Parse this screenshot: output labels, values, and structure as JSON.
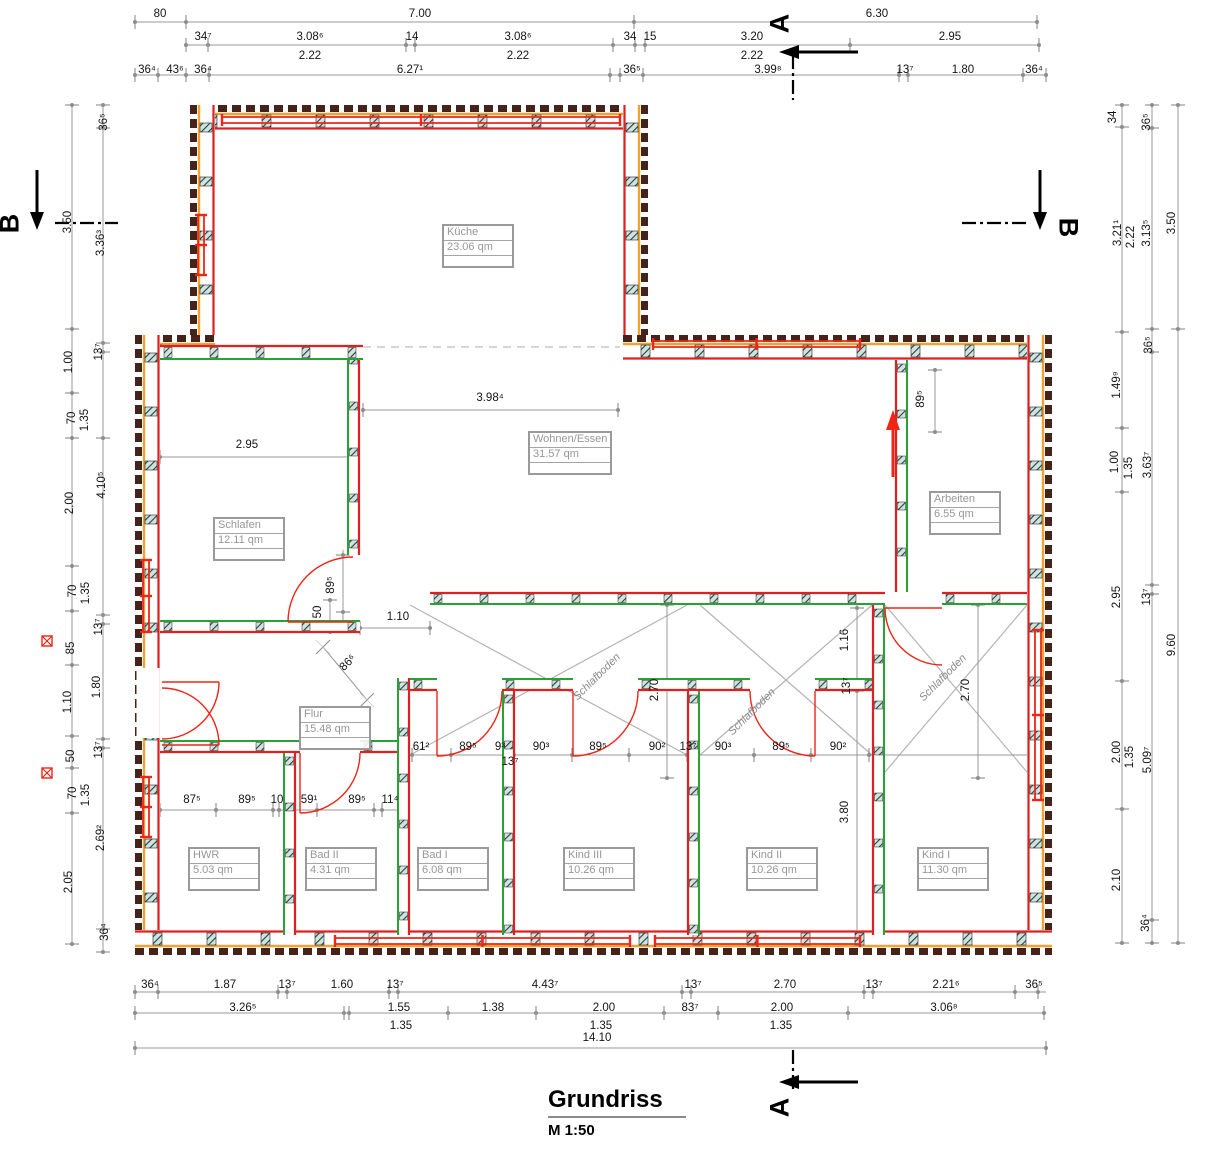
{
  "title": {
    "name": "Grundriss",
    "scale": "M 1:50"
  },
  "colors": {
    "wall_dark": "#45231a",
    "insulation_orange": "#f0a232",
    "inner_red": "#e02020",
    "partition_green": "#2aa233",
    "dim_gray": "#9a9a9a",
    "label_gray": "#979797",
    "window_red": "#ee2517",
    "zone_gray": "#b4b4b4"
  },
  "section_markers": {
    "top": "A",
    "bottom": "A",
    "left": "B",
    "right": "B"
  },
  "rooms": [
    {
      "name": "Küche",
      "area": "23.06 qm",
      "x": 442,
      "y": 224
    },
    {
      "name": "Wohnen/Essen",
      "area": "31.57 qm",
      "x": 528,
      "y": 431
    },
    {
      "name": "Schlafen",
      "area": "12.11 qm",
      "x": 213,
      "y": 517
    },
    {
      "name": "Arbeiten",
      "area": "6.55 qm",
      "x": 929,
      "y": 491
    },
    {
      "name": "Flur",
      "area": "15.48 qm",
      "x": 299,
      "y": 706
    },
    {
      "name": "HWR",
      "area": "5.03 qm",
      "x": 188,
      "y": 847
    },
    {
      "name": "Bad II",
      "area": "4.31 qm",
      "x": 305,
      "y": 847
    },
    {
      "name": "Bad I",
      "area": "6.08 qm",
      "x": 417,
      "y": 847
    },
    {
      "name": "Kind III",
      "area": "10.26 qm",
      "x": 563,
      "y": 847
    },
    {
      "name": "Kind II",
      "area": "10.26 qm",
      "x": 746,
      "y": 847
    },
    {
      "name": "Kind I",
      "area": "11.30 qm",
      "x": 917,
      "y": 847
    }
  ],
  "schlafboden_labels": [
    {
      "text": "Schlafboden",
      "x": 597,
      "y": 677
    },
    {
      "text": "Schlafboden",
      "x": 752,
      "y": 712
    },
    {
      "text": "Schlafboden",
      "x": 943,
      "y": 678
    }
  ],
  "dim_labels": [
    {
      "t": "80",
      "x": 160,
      "y": 14
    },
    {
      "t": "7.00",
      "x": 420,
      "y": 14
    },
    {
      "t": "6.30",
      "x": 877,
      "y": 14
    },
    {
      "t": "34⁷",
      "x": 203,
      "y": 37
    },
    {
      "t": "3.08⁶",
      "x": 310,
      "y": 37
    },
    {
      "t": "14",
      "x": 412,
      "y": 37
    },
    {
      "t": "3.08⁶",
      "x": 518,
      "y": 37
    },
    {
      "t": "34",
      "x": 630,
      "y": 37
    },
    {
      "t": "15",
      "x": 650,
      "y": 37
    },
    {
      "t": "3.20",
      "x": 752,
      "y": 37
    },
    {
      "t": "2.95",
      "x": 950,
      "y": 37
    },
    {
      "t": "2.22",
      "x": 310,
      "y": 56
    },
    {
      "t": "2.22",
      "x": 518,
      "y": 56
    },
    {
      "t": "2.22",
      "x": 752,
      "y": 56
    },
    {
      "t": "36⁴",
      "x": 147,
      "y": 70
    },
    {
      "t": "43⁶",
      "x": 175,
      "y": 70
    },
    {
      "t": "36⁴",
      "x": 203,
      "y": 70
    },
    {
      "t": "6.27¹",
      "x": 410,
      "y": 70
    },
    {
      "t": "36⁵",
      "x": 632,
      "y": 70
    },
    {
      "t": "3.99⁸",
      "x": 768,
      "y": 70
    },
    {
      "t": "13⁷",
      "x": 905,
      "y": 70
    },
    {
      "t": "1.80",
      "x": 963,
      "y": 70
    },
    {
      "t": "36⁴",
      "x": 1034,
      "y": 70
    },
    {
      "t": "36⁴",
      "x": 150,
      "y": 985
    },
    {
      "t": "1.87",
      "x": 225,
      "y": 985
    },
    {
      "t": "13⁷",
      "x": 287,
      "y": 985
    },
    {
      "t": "1.60",
      "x": 342,
      "y": 985
    },
    {
      "t": "13⁷",
      "x": 395,
      "y": 985
    },
    {
      "t": "4.43⁷",
      "x": 545,
      "y": 985
    },
    {
      "t": "13⁷",
      "x": 693,
      "y": 985
    },
    {
      "t": "2.70",
      "x": 785,
      "y": 985
    },
    {
      "t": "13⁷",
      "x": 874,
      "y": 985
    },
    {
      "t": "2.21⁶",
      "x": 946,
      "y": 985
    },
    {
      "t": "36⁵",
      "x": 1034,
      "y": 985
    },
    {
      "t": "3.26⁵",
      "x": 243,
      "y": 1008
    },
    {
      "t": "1.55",
      "x": 399,
      "y": 1008
    },
    {
      "t": "1.38",
      "x": 493,
      "y": 1008
    },
    {
      "t": "2.00",
      "x": 604,
      "y": 1008
    },
    {
      "t": "83⁷",
      "x": 690,
      "y": 1008
    },
    {
      "t": "2.00",
      "x": 782,
      "y": 1008
    },
    {
      "t": "3.06⁸",
      "x": 944,
      "y": 1008
    },
    {
      "t": "1.35",
      "x": 401,
      "y": 1026
    },
    {
      "t": "1.35",
      "x": 601,
      "y": 1026
    },
    {
      "t": "1.35",
      "x": 781,
      "y": 1026
    },
    {
      "t": "14.10",
      "x": 597,
      "y": 1038
    },
    {
      "t": "3.50",
      "x": 68,
      "y": 222,
      "r": -90
    },
    {
      "t": "1.00",
      "x": 69,
      "y": 362,
      "r": -90
    },
    {
      "t": "70",
      "x": 72,
      "y": 418,
      "r": -90
    },
    {
      "t": "1.35",
      "x": 85,
      "y": 420,
      "r": -90
    },
    {
      "t": "2.00",
      "x": 70,
      "y": 503,
      "r": -90
    },
    {
      "t": "70",
      "x": 73,
      "y": 591,
      "r": -90
    },
    {
      "t": "1.35",
      "x": 86,
      "y": 593,
      "r": -90
    },
    {
      "t": "85",
      "x": 71,
      "y": 648,
      "r": -90
    },
    {
      "t": "1.10",
      "x": 68,
      "y": 702,
      "r": -90
    },
    {
      "t": "50",
      "x": 71,
      "y": 756,
      "r": -90
    },
    {
      "t": "70",
      "x": 73,
      "y": 793,
      "r": -90
    },
    {
      "t": "1.35",
      "x": 86,
      "y": 795,
      "r": -90
    },
    {
      "t": "2.05",
      "x": 69,
      "y": 882,
      "r": -90
    },
    {
      "t": "36⁵",
      "x": 104,
      "y": 122,
      "r": -90
    },
    {
      "t": "3.36³",
      "x": 101,
      "y": 243,
      "r": -90
    },
    {
      "t": "13⁷",
      "x": 99,
      "y": 352,
      "r": -90
    },
    {
      "t": "4.10⁵",
      "x": 102,
      "y": 485,
      "r": -90
    },
    {
      "t": "13⁷",
      "x": 99,
      "y": 627,
      "r": -90
    },
    {
      "t": "1.80",
      "x": 97,
      "y": 687,
      "r": -90
    },
    {
      "t": "13⁷",
      "x": 99,
      "y": 750,
      "r": -90
    },
    {
      "t": "2.69²",
      "x": 101,
      "y": 838,
      "r": -90
    },
    {
      "t": "36⁴",
      "x": 105,
      "y": 932,
      "r": -90
    },
    {
      "t": "34",
      "x": 1113,
      "y": 117,
      "r": -90
    },
    {
      "t": "3.21¹",
      "x": 1118,
      "y": 233,
      "r": -90
    },
    {
      "t": "1.49⁹",
      "x": 1117,
      "y": 385,
      "r": -90
    },
    {
      "t": "1.00",
      "x": 1115,
      "y": 462,
      "r": -90
    },
    {
      "t": "2.95",
      "x": 1117,
      "y": 597,
      "r": -90
    },
    {
      "t": "2.00",
      "x": 1117,
      "y": 752,
      "r": -90
    },
    {
      "t": "2.10",
      "x": 1117,
      "y": 880,
      "r": -90
    },
    {
      "t": "2.22",
      "x": 1131,
      "y": 237,
      "r": -90
    },
    {
      "t": "1.35",
      "x": 1129,
      "y": 468,
      "r": -90
    },
    {
      "t": "1.35",
      "x": 1130,
      "y": 757,
      "r": -90
    },
    {
      "t": "36⁵",
      "x": 1147,
      "y": 122,
      "r": -90
    },
    {
      "t": "3.13⁵",
      "x": 1147,
      "y": 233,
      "r": -90
    },
    {
      "t": "36⁵",
      "x": 1149,
      "y": 345,
      "r": -90
    },
    {
      "t": "3.63⁷",
      "x": 1148,
      "y": 465,
      "r": -90
    },
    {
      "t": "13⁷",
      "x": 1147,
      "y": 597,
      "r": -90
    },
    {
      "t": "5.09⁷",
      "x": 1148,
      "y": 760,
      "r": -90
    },
    {
      "t": "36⁴",
      "x": 1146,
      "y": 923,
      "r": -90
    },
    {
      "t": "3.50",
      "x": 1172,
      "y": 223,
      "r": -90
    },
    {
      "t": "9.60",
      "x": 1172,
      "y": 645,
      "r": -90
    },
    {
      "t": "3.98⁴",
      "x": 490,
      "y": 398
    },
    {
      "t": "2.95",
      "x": 247,
      "y": 445
    },
    {
      "t": "89⁵",
      "x": 921,
      "y": 399,
      "r": -90
    },
    {
      "t": "89⁵",
      "x": 331,
      "y": 585,
      "r": -90
    },
    {
      "t": "50",
      "x": 318,
      "y": 612,
      "r": -90
    },
    {
      "t": "1.10",
      "x": 398,
      "y": 617
    },
    {
      "t": "86⁶",
      "x": 348,
      "y": 663,
      "r": -45
    },
    {
      "t": "61²",
      "x": 421,
      "y": 747
    },
    {
      "t": "89⁵",
      "x": 468,
      "y": 747
    },
    {
      "t": "9³",
      "x": 500,
      "y": 747
    },
    {
      "t": "13⁷",
      "x": 510,
      "y": 762
    },
    {
      "t": "90³",
      "x": 541,
      "y": 747
    },
    {
      "t": "89⁵",
      "x": 598,
      "y": 747
    },
    {
      "t": "90²",
      "x": 657,
      "y": 747
    },
    {
      "t": "13⁷",
      "x": 688,
      "y": 747
    },
    {
      "t": "90³",
      "x": 723,
      "y": 747
    },
    {
      "t": "89⁵",
      "x": 781,
      "y": 747
    },
    {
      "t": "90²",
      "x": 838,
      "y": 747
    },
    {
      "t": "2.70",
      "x": 655,
      "y": 690,
      "r": -90
    },
    {
      "t": "1.16",
      "x": 845,
      "y": 640,
      "r": -90
    },
    {
      "t": "13⁷",
      "x": 847,
      "y": 686,
      "r": -90
    },
    {
      "t": "3.80",
      "x": 845,
      "y": 812,
      "r": -90
    },
    {
      "t": "2.70",
      "x": 966,
      "y": 690,
      "r": -90
    },
    {
      "t": "87⁵",
      "x": 192,
      "y": 800
    },
    {
      "t": "89⁵",
      "x": 247,
      "y": 800
    },
    {
      "t": "10",
      "x": 277,
      "y": 800
    },
    {
      "t": "59¹",
      "x": 309,
      "y": 800
    },
    {
      "t": "89⁵",
      "x": 357,
      "y": 800
    },
    {
      "t": "11⁴",
      "x": 390,
      "y": 800
    }
  ]
}
